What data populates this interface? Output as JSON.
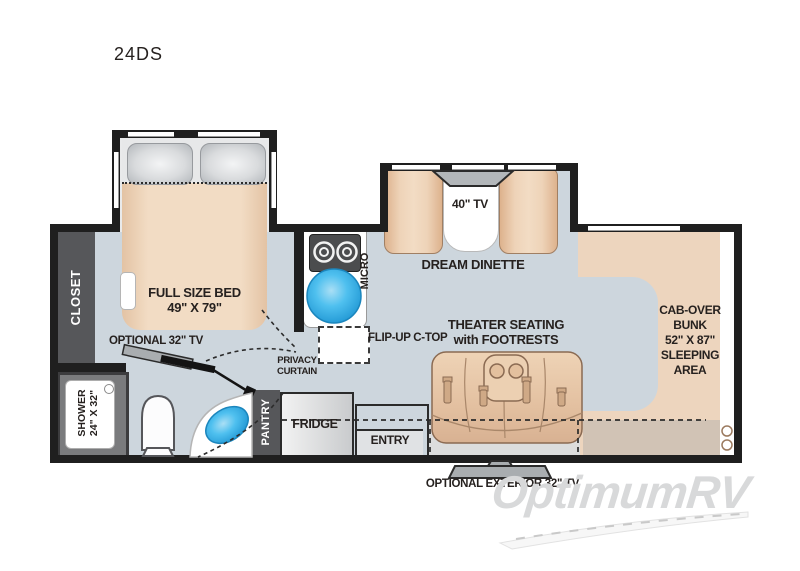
{
  "page": {
    "title": "24DS",
    "watermark": "OptimumRV"
  },
  "rooms": {
    "bedroom": {
      "closet": "CLOSET",
      "bed_l1": "FULL SIZE BED",
      "bed_l2": "49\" X 79\"",
      "optional_tv": "OPTIONAL 32\" TV",
      "privacy_l1": "PRIVACY",
      "privacy_l2": "CURTAIN"
    },
    "bathroom": {
      "shower_l1": "SHOWER",
      "shower_l2": "24\" X 32\""
    },
    "kitchen": {
      "micro": "MICRO",
      "flip_up": "FLIP-UP C-TOP",
      "pantry": "PANTRY",
      "fridge": "FRIDGE"
    },
    "dinette": {
      "tv": "40\" TV",
      "label": "DREAM DINETTE"
    },
    "living": {
      "theater_l1": "THEATER SEATING",
      "theater_l2": "with FOOTRESTS",
      "entry": "ENTRY"
    },
    "cab": {
      "bunk_l1": "CAB-OVER",
      "bunk_l2": "BUNK",
      "bunk_l3": "52\" X 87\"",
      "bunk_l4": "SLEEPING",
      "bunk_l5": "AREA",
      "exterior_tv": "OPTIONAL EXTERIOR 32\" TV"
    }
  },
  "colors": {
    "floor": "#cdd6dd",
    "upholstery_tan": "#edd5be",
    "wall": "#1f1f1f",
    "cabinet_gray": "#56575a",
    "sink_blue": "#2fa9e1",
    "cab_dash": "#d1c3b5",
    "watermark_gray": "#d8d9da"
  }
}
